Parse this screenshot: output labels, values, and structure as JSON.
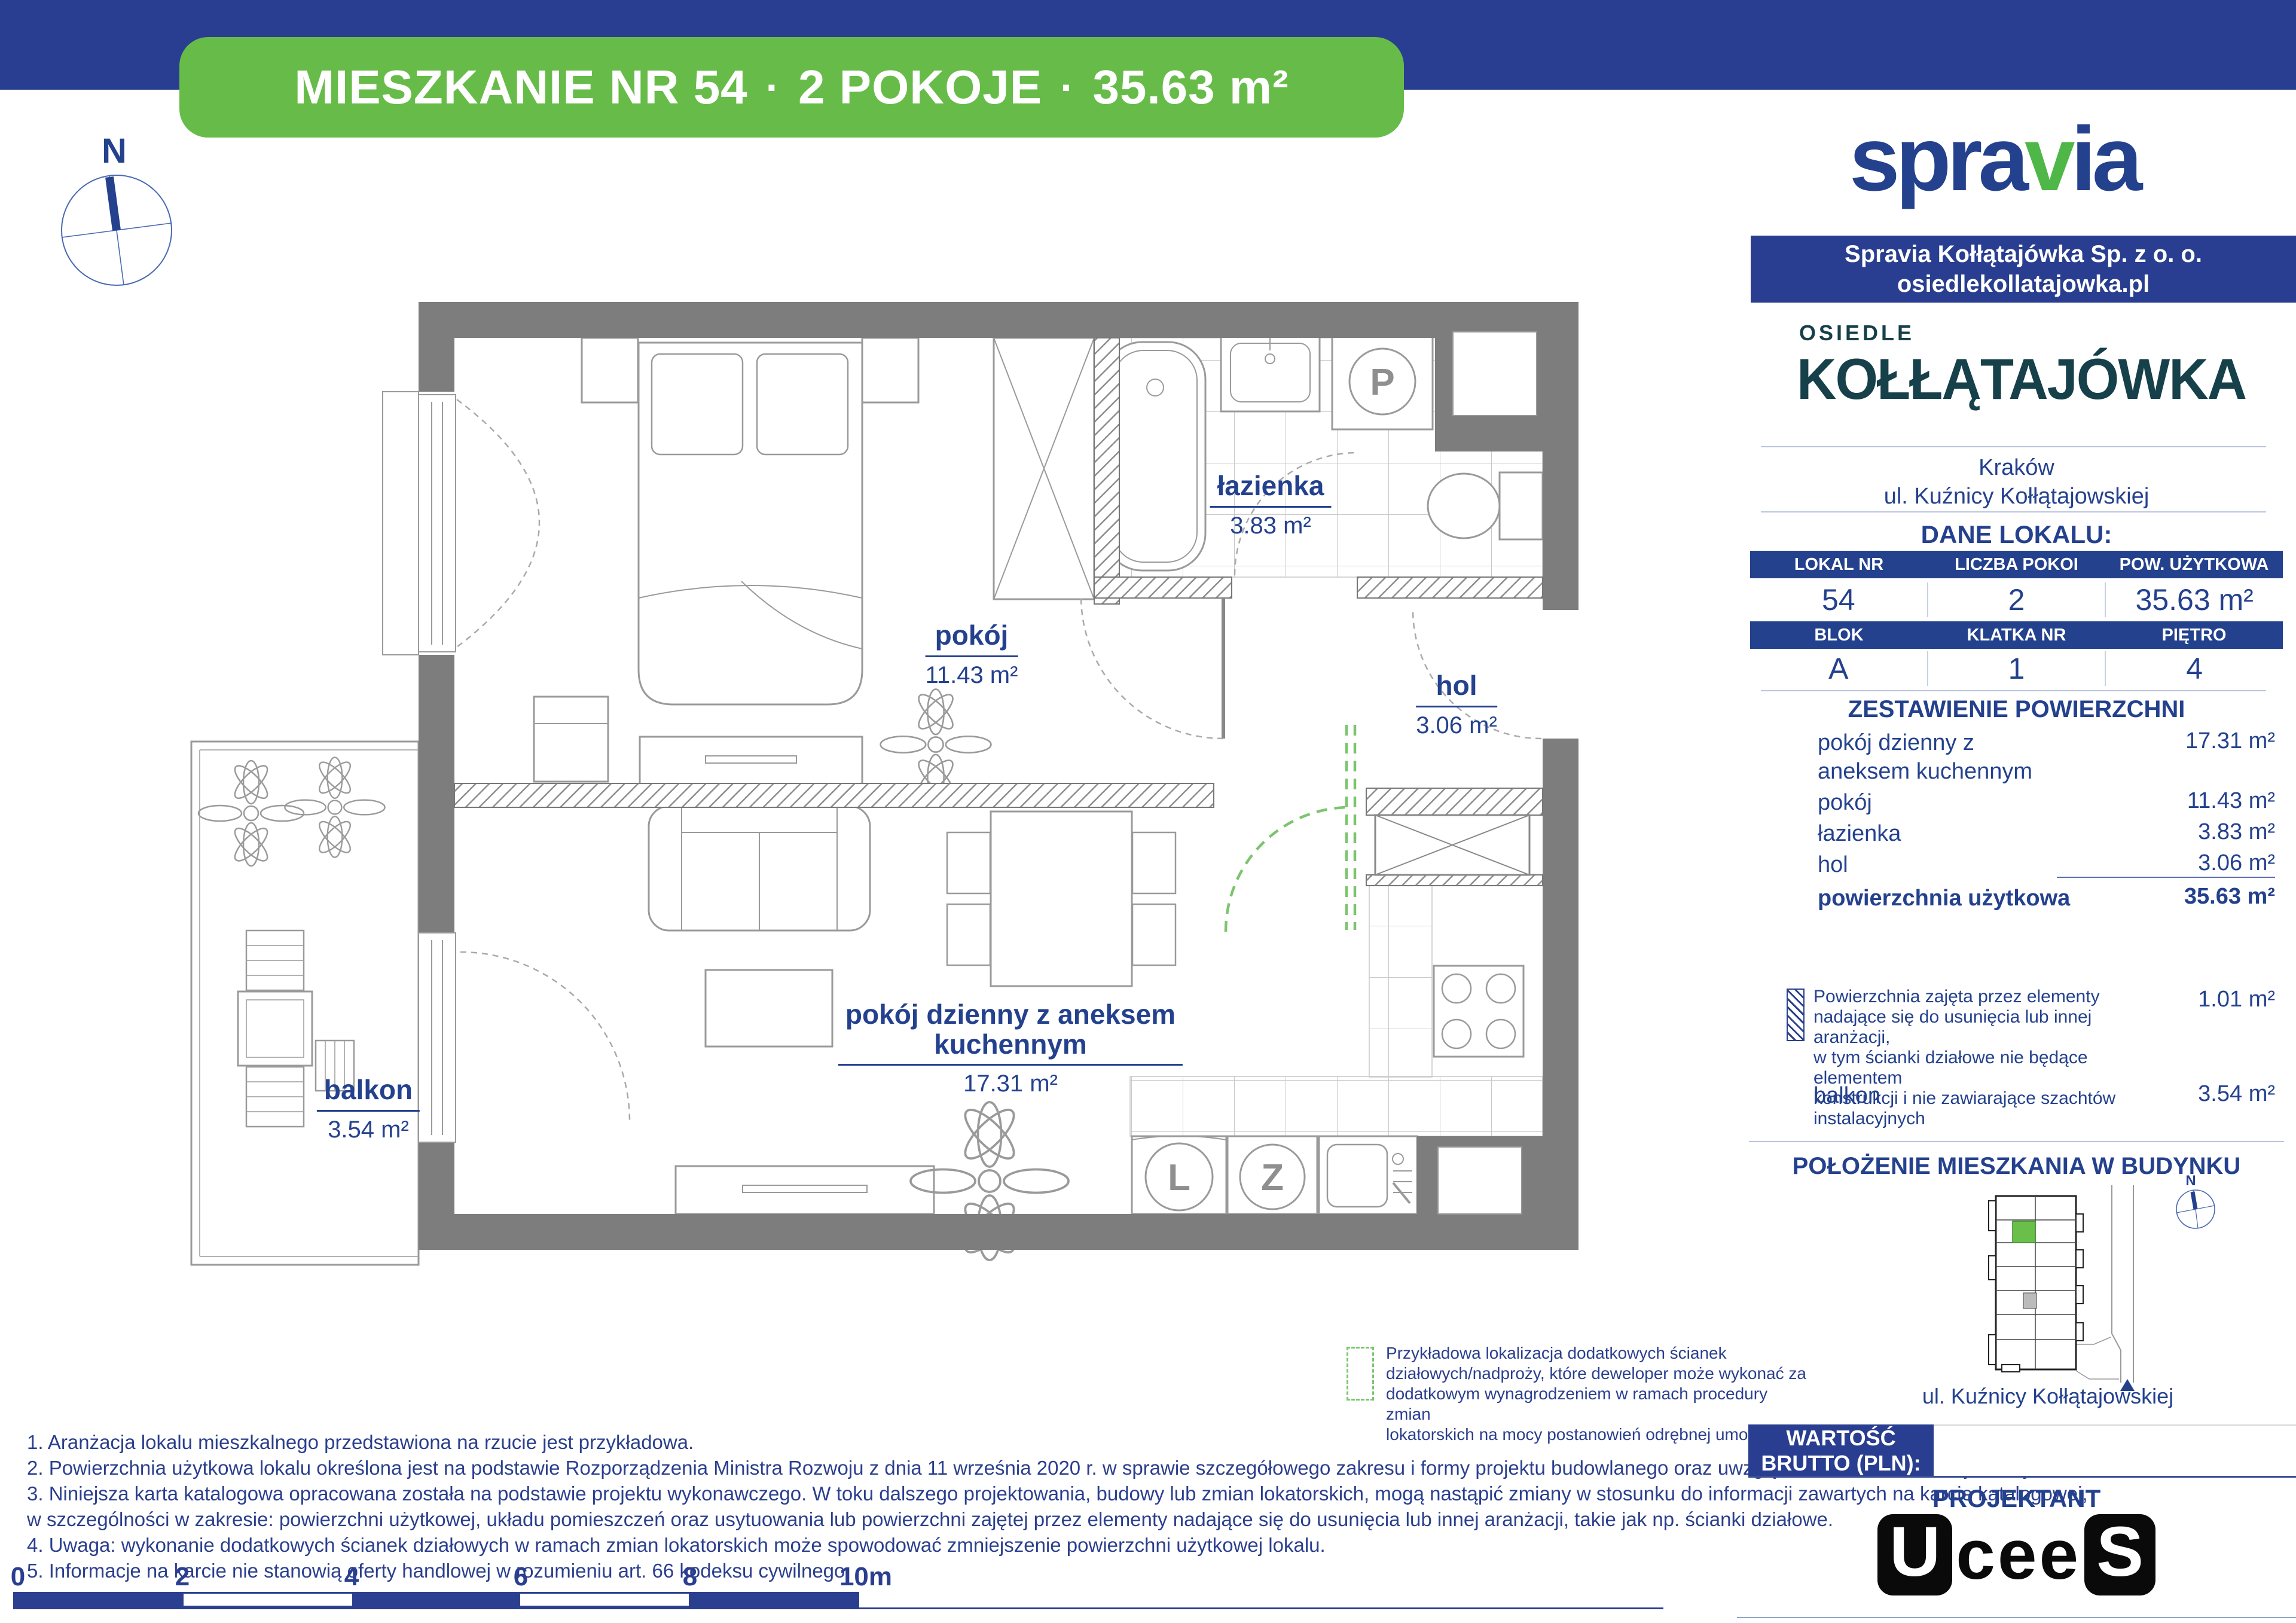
{
  "banner": {
    "part1": "MIESZKANIE NR 54",
    "sep": "·",
    "part2": "2 POKOJE",
    "part3": "35.63  m²"
  },
  "compass": {
    "north_label": "N"
  },
  "plan": {
    "rooms": {
      "bedroom": {
        "name": "pokój",
        "area": "11.43 m²"
      },
      "bathroom": {
        "name": "łazienka",
        "area": "3.83 m²"
      },
      "hall": {
        "name": "hol",
        "area": "3.06 m²"
      },
      "living": {
        "name_line1": "pokój dzienny z aneksem",
        "name_line2": "kuchennym",
        "area": "17.31 m²"
      },
      "balcony": {
        "name": "balkon",
        "area": "3.54 m²"
      }
    },
    "appliances": {
      "washer": "P",
      "fridge": "L",
      "dishwasher": "Z"
    }
  },
  "green_legend": {
    "line1": "Przykładowa lokalizacja dodatkowych ścianek",
    "line2": "działowych/nadproży, które deweloper może wykonać za",
    "line3": "dodatkowym wynagrodzeniem w ramach procedury zmian",
    "line4": "lokatorskich na mocy postanowień odrębnej umowy"
  },
  "footnotes": {
    "line1": "1. Aranżacja lokalu mieszkalnego przedstawiona na rzucie jest przykładowa.",
    "line2": "2. Powierzchnia użytkowa lokalu określona jest na podstawie Rozporządzenia Ministra Rozwoju z dnia 11 września 2020 r. w sprawie szczegółowego zakresu i formy projektu budowlanego oraz uwzględnieniu treści Polskiej Normy PN-ISO 9836:2022-07",
    "line3": "3. Niniejsza karta katalogowa opracowana została na podstawie projektu wykonawczego. W toku dalszego projektowania, budowy lub zmian lokatorskich, mogą nastąpić zmiany w stosunku do informacji zawartych na karcie katalogowej,",
    "line4": "w szczególności w zakresie: powierzchni użytkowej, układu pomieszczeń oraz usytuowania lub powierzchni zajętej przez elementy nadające się do usunięcia lub innej aranżacji, takie jak np. ścianki działowe.",
    "line5": "4. Uwaga: wykonanie dodatkowych ścianek działowych w ramach zmian lokatorskich może spowodować zmniejszenie powierzchni użytkowej lokalu.",
    "line6": "5. Informacje na karcie nie stanowią oferty handlowej w rozumieniu art. 66 kodeksu cywilnego."
  },
  "scalebar": {
    "t0": "0",
    "t1": "2",
    "t2": "4",
    "t3": "6",
    "t4": "8",
    "t5": "10m"
  },
  "sidebar": {
    "brand": {
      "pre": "spra",
      "mid": "v",
      "post": "ia"
    },
    "company": {
      "line1": "Spravia Kołłątajówka Sp. z o. o.",
      "line2": "osiedlekollatajowka.pl"
    },
    "estate": {
      "line1": "OSIEDLE",
      "line2": "KOŁŁĄTAJÓWKA"
    },
    "location": {
      "city": "Kraków",
      "street": "ul. Kuźnicy Kołłątajowskiej"
    },
    "dane_heading": "DANE LOKALU:",
    "table1": {
      "h1": "LOKAL NR",
      "h2": "LICZBA POKOI",
      "h3": "POW. UŻYTKOWA",
      "v1": "54",
      "v2": "2",
      "v3": "35.63 m²"
    },
    "table2": {
      "h1": "BLOK",
      "h2": "KLATKA NR",
      "h3": "PIĘTRO",
      "v1": "A",
      "v2": "1",
      "v3": "4"
    },
    "zestawienie": {
      "heading": "ZESTAWIENIE POWIERZCHNI",
      "row1_label": "pokój dzienny z",
      "row1_label2": "aneksem kuchennym",
      "row1_value": "17.31 m²",
      "row2_label": "pokój",
      "row2_value": "11.43 m²",
      "row3_label": "łazienka",
      "row3_value": "3.83 m²",
      "row4_label": "hol",
      "row4_value": "3.06 m²",
      "total_label": "powierzchnia użytkowa",
      "total_value": "35.63 m²"
    },
    "note": {
      "line1": "Powierzchnia zajęta przez elementy",
      "line2": "nadające się do usunięcia lub innej aranżacji,",
      "line3": "w tym ścianki działowe nie będące elementem",
      "line4": "konstrukcji i nie zawiarające szachtów instalacyjnych",
      "value": "1.01 m²"
    },
    "balcony_row": {
      "label": "balkon",
      "value": "3.54 m²"
    },
    "position": {
      "heading": "POŁOŻENIE MIESZKANIA W BUDYNKU",
      "street": "ul. Kuźnicy Kołłątajowskiej",
      "compass_label": "N"
    },
    "price": {
      "label_line1": "WARTOŚĆ",
      "label_line2": "BRUTTO (PLN):",
      "value": ""
    },
    "projektant": "PROJEKTANT",
    "designer_logo": {
      "box1": "U",
      "mid": "cee",
      "box2": "S"
    }
  }
}
